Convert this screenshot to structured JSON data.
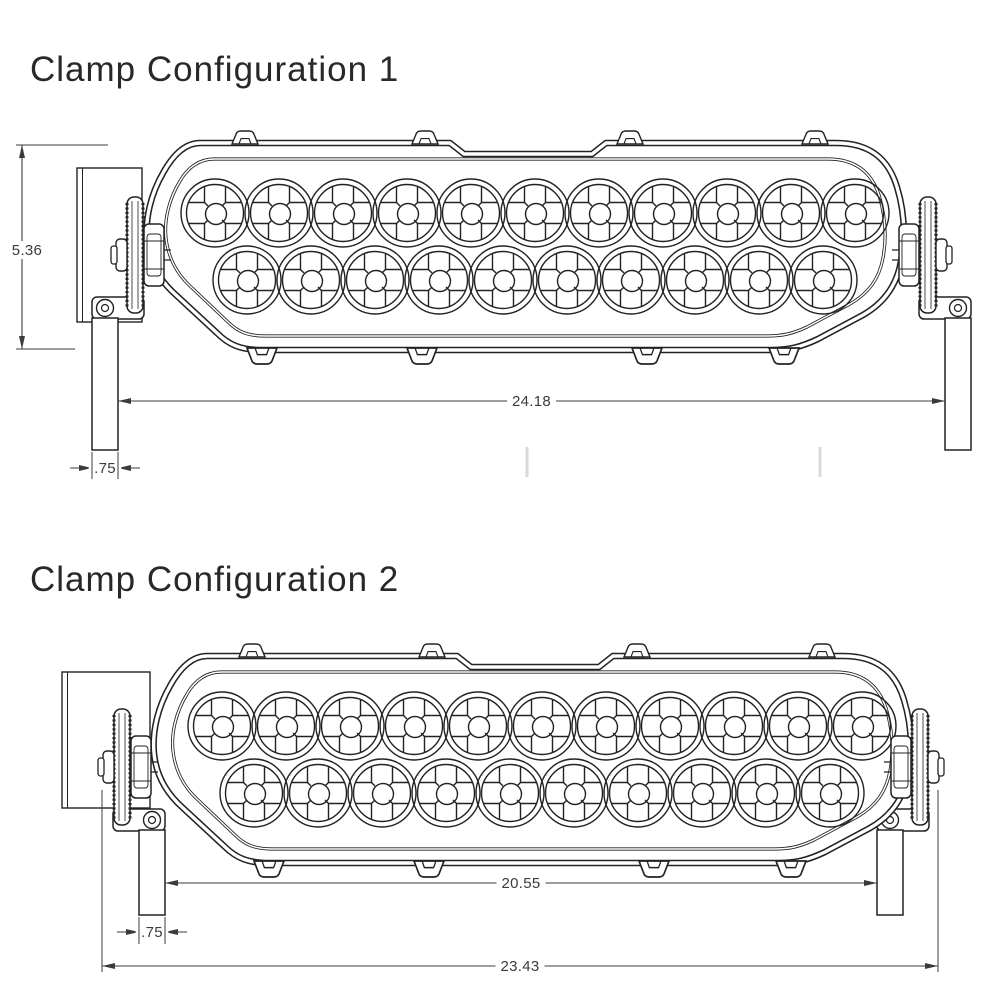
{
  "colors": {
    "background": "#ffffff",
    "line": "#222222",
    "dim": "#3b3b3b",
    "faint_mark": "#d9d9d9"
  },
  "lightbar": {
    "top_row_leds": 11,
    "bottom_row_leds": 10
  },
  "configs": [
    {
      "title": "Clamp Configuration 1",
      "clamp_style": "posts-outboard",
      "dimensions": {
        "height": "5.36",
        "between_posts": "24.18",
        "post_width": ".75"
      }
    },
    {
      "title": "Clamp Configuration 2",
      "clamp_style": "posts-inboard",
      "dimensions": {
        "between_posts": "20.55",
        "post_width": ".75",
        "overall_width": "23.43"
      }
    }
  ]
}
